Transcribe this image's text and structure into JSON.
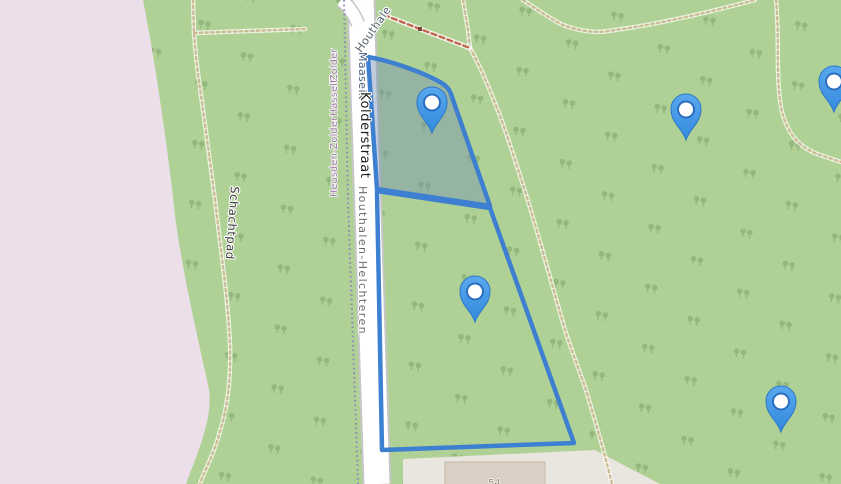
{
  "map": {
    "road_labels": {
      "street": "Kolderstraat",
      "destination_up": "Maaseik",
      "destination_diagonal": "Houthale",
      "municipality_right": "Houthalen-Helchteren",
      "destinations_left": [
        "Zolder",
        "Hasselt",
        "Heusden-Zolder"
      ]
    },
    "path_labels": {
      "schachtpad": "Schachtpad"
    },
    "building_number": "54",
    "markers": [
      {
        "x": 432,
        "y": 133
      },
      {
        "x": 686,
        "y": 140
      },
      {
        "x": 834,
        "y": 112
      },
      {
        "x": 475,
        "y": 322
      },
      {
        "x": 781,
        "y": 432
      }
    ],
    "colors": {
      "forest_green": "#afd195",
      "restricted_pink": "#ecdfe9",
      "parcel_outline": "#3d7fd0",
      "parcel_fill": "rgba(118,145,178,0.45)",
      "marker_blue": "#4498e8",
      "road_fill": "#ffffff",
      "service_area": "#e9e5df",
      "building_fill": "#d9cfc4"
    }
  }
}
